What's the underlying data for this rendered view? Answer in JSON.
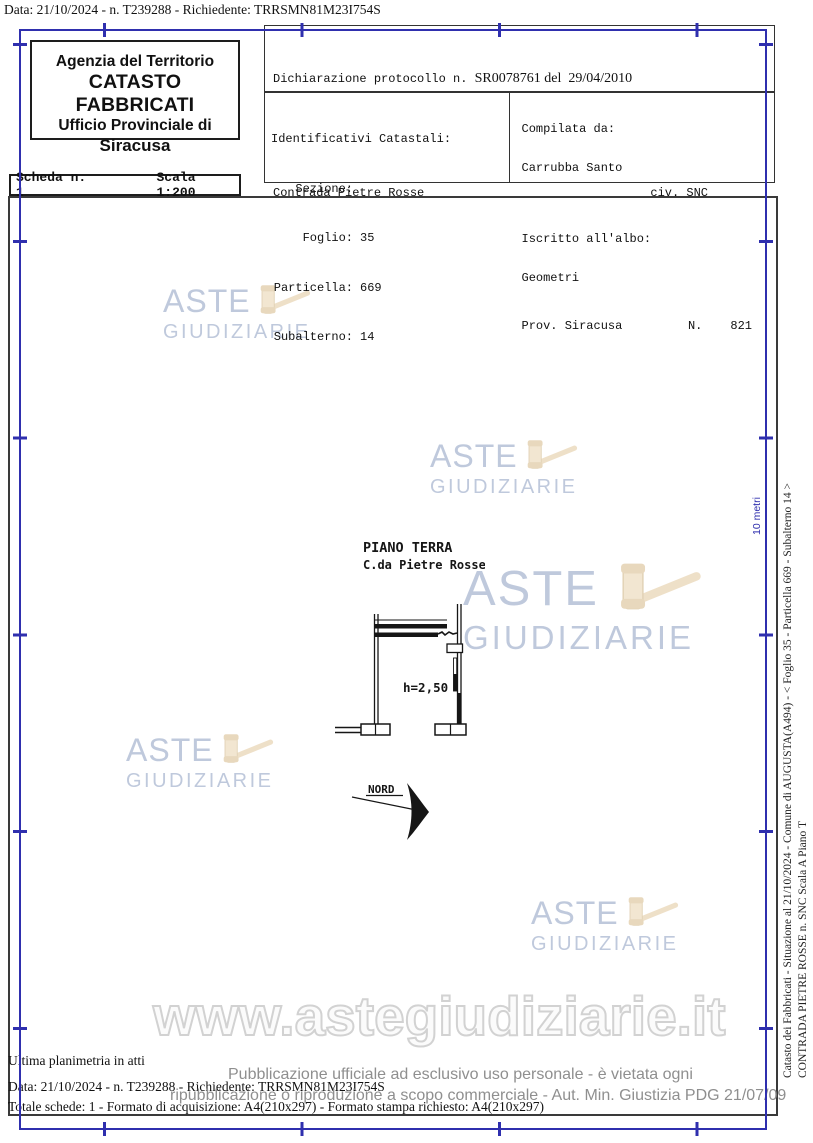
{
  "top_line": "Data: 21/10/2024 - n. T239288 - Richiedente: TRRSMN81M23I754S",
  "header": {
    "agency": {
      "line1": "Agenzia del Territorio",
      "line2": "CATASTO FABBRICATI",
      "line3": "Ufficio Provinciale di",
      "line4": "Siracusa"
    },
    "scheda": {
      "label": "Scheda n. 1",
      "scala": "Scala 1:200"
    },
    "declaration": {
      "line1_mono": "Dichiarazione protocollo n. ",
      "line1_serif": "SR0078761 del  29/04/2010",
      "line2": "Planimetria di u.i.u. in Comune di Augusta",
      "line3": "Contrada Pietre Rosse",
      "civ": "civ. SNC"
    },
    "identifiers": {
      "title": "Identificativi Catastali:",
      "rows": [
        {
          "label": "Sezione:",
          "value": ""
        },
        {
          "label": "Foglio:",
          "value": "35"
        },
        {
          "label": "Particella:",
          "value": "669"
        },
        {
          "label": "Subalterno:",
          "value": "14"
        }
      ]
    },
    "compiler": {
      "compiled_by_label": "Compilata da:",
      "compiled_by": "Carrubba Santo",
      "register_label": "Iscritto all'albo:",
      "register": "Geometri",
      "province": "Prov. Siracusa",
      "n_label": "N.",
      "n_value": "821"
    }
  },
  "plan": {
    "title": "PIANO TERRA",
    "subtitle": "C.da Pietre Rosse",
    "height_label": "h=2,50",
    "north_label": "NORD"
  },
  "watermark": {
    "line1": "ASTE",
    "line2": "GIUDIZIARIE",
    "text_color": "#b5c0d7",
    "gavel_color": "#ecdbbf"
  },
  "url_watermark": "www.astegiudiziarie.it",
  "scale_ruler": {
    "label": "10 metri",
    "color": "#2f2fae"
  },
  "side_vertical": {
    "line1": "Catasto dei Fabbricati - Situazione al 21/10/2024 - Comune di AUGUSTA(A494) - <  Foglio 35 - Particella  669 - Subalterno 14 >",
    "line2": "CONTRADA PIETRE ROSSE n. SNC  Scala A Piano T"
  },
  "footer": {
    "line1": "Ultima planimetria in atti",
    "line2": "Data: 21/10/2024 - n. T239288 - Richiedente: TRRSMN81M23I754S",
    "line3": "Totale schede: 1 - Formato di acquisizione: A4(210x297) - Formato stampa richiesto: A4(210x297)",
    "legal1": "Pubblicazione ufficiale ad esclusivo uso personale - è vietata ogni",
    "legal2": "ripubblicazione o riproduzione a scopo commerciale - Aut. Min. Giustizia PDG 21/07/09"
  }
}
